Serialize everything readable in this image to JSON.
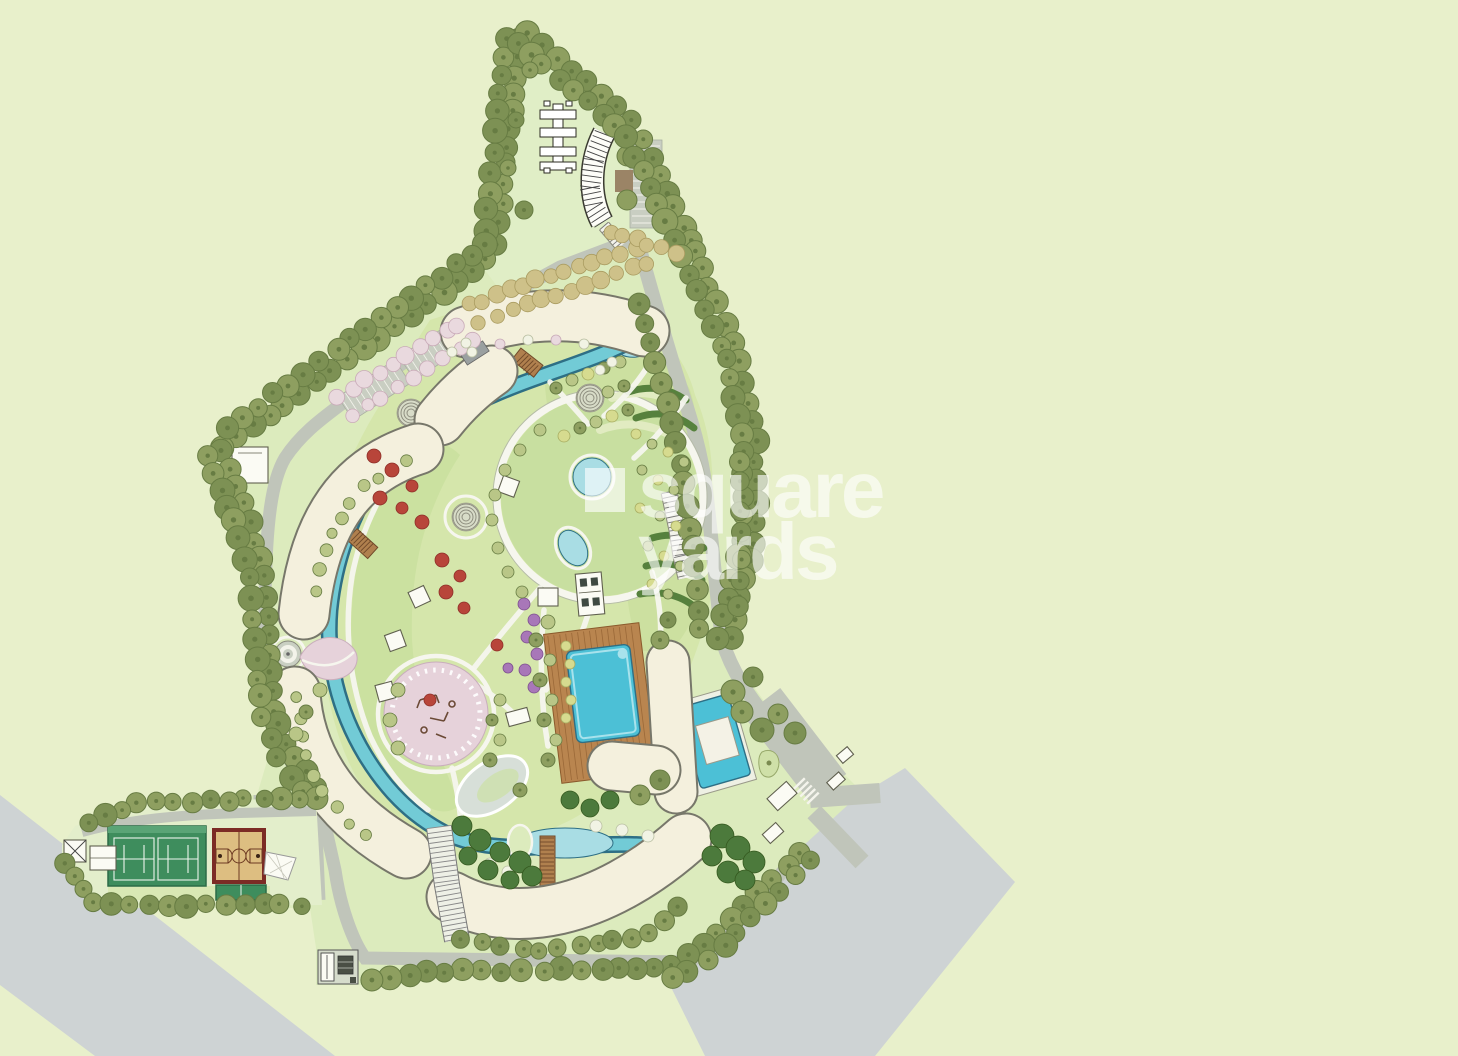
{
  "watermark": {
    "icon": "square-glyph",
    "line1": "square",
    "line2": "yards",
    "color": "rgba(255,255,255,0.62)"
  },
  "palette": {
    "bg": "#e8f0cb",
    "offsite": "#ced3d4",
    "site": "#dcebbd",
    "site_top": "#e0eec6",
    "park": "#d5e6ab",
    "bed": "#c9df9e",
    "road": "#c0c5ba",
    "road_edge": "#a9afa2",
    "apron": "#c9cec2",
    "lawn": "#c8dfa0",
    "wave": "#e3ecc4",
    "hedge": "#56813d",
    "water": "#72cbd6",
    "water_line": "#2e6f85",
    "pond": "#a9dde4",
    "pool": "#4cc0d6",
    "pool_light": "#a8e2ec",
    "deck": "#b9854f",
    "deck_line": "#8a5a2c",
    "bldg": "#f4f0dd",
    "bldg_line": "#77776a",
    "path": "#f6f6ee",
    "court": "#3e8d5d",
    "court_edge": "#2c6b47",
    "bball": "#ddbe81",
    "bball_border": "#7c2b25",
    "bball_mark": "#6d3a22",
    "plaza": "#e6d2da",
    "plaza_line": "#c9aebc",
    "tree_olive": "#8e9f60",
    "tree_olive2": "#7d9154",
    "tree_olive_d": "#677c43",
    "tree_pale": "#b9c687",
    "tree_dark": "#4c7a3c",
    "tree_khaki": "#cec189",
    "tree_khaki_d": "#aa9c61",
    "tree_pink": "#e9d9de",
    "tree_pink_d": "#c9abb8",
    "tree_red": "#b8453a",
    "tree_red_d": "#8e2f28",
    "tree_purple": "#a877b8",
    "tree_yellow": "#d6db8f",
    "tree_white": "#f1f3e4"
  }
}
